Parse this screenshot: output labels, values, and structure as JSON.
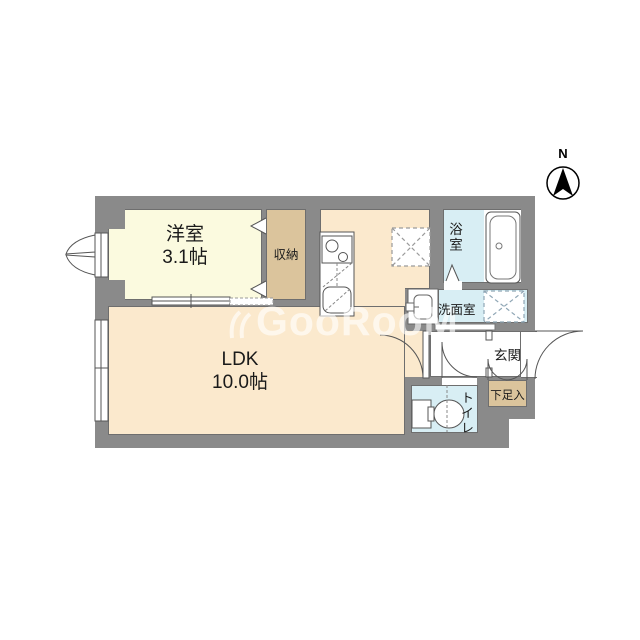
{
  "compass": {
    "north_label": "N"
  },
  "watermark": {
    "text": "GooRooM"
  },
  "rooms": {
    "western": {
      "name": "洋室",
      "size": "3.1帖"
    },
    "closet": {
      "label": "収納"
    },
    "ldk": {
      "name": "LDK",
      "size": "10.0帖"
    },
    "bathroom": {
      "label": "浴室"
    },
    "washroom": {
      "label": "洗面室"
    },
    "entrance": {
      "label": "玄関"
    },
    "shoe_cabinet": {
      "label": "下足入"
    },
    "toilet": {
      "label": "トイレ"
    }
  },
  "colors": {
    "wall": "#8a8a8a",
    "western_room_fill": "#fbfadf",
    "closet_fill": "#dbc49c",
    "ldk_fill": "#fbe9cd",
    "wet_area_fill": "#d8eef4",
    "entrance_fill": "#ffffff",
    "background": "#ffffff"
  }
}
